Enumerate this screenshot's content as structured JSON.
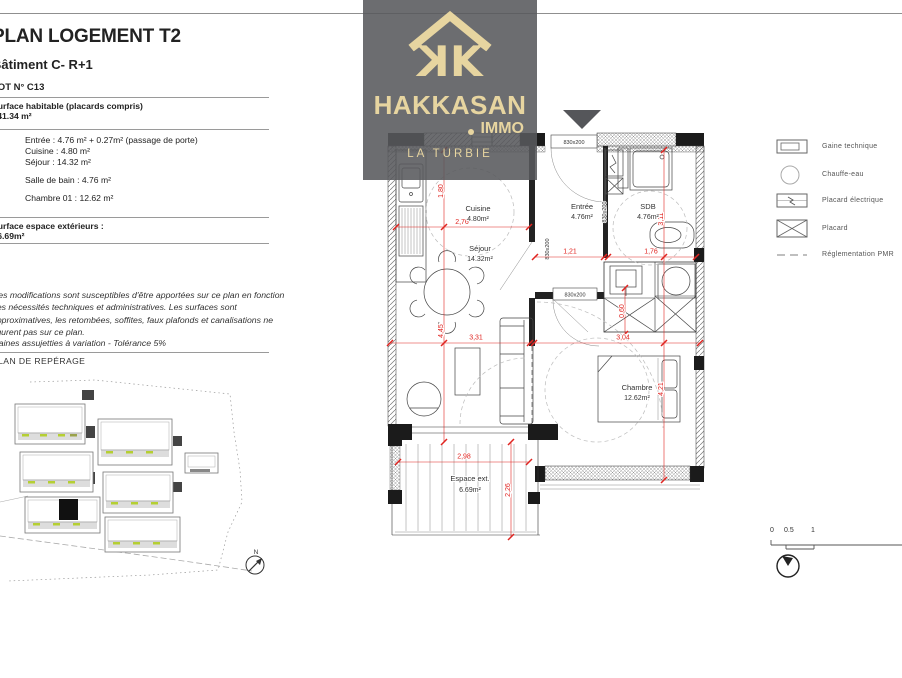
{
  "page": {
    "title": "PLAN LOGEMENT T2",
    "building": "Bâtiment C- R+1",
    "lot": "LOT N° C13"
  },
  "surfaces": {
    "habitable_label": "Surface habitable (placards compris)",
    "habitable_value": ": 41.34 m²",
    "rooms_group1": [
      "Entrée : 4.76 m² + 0.27m² (passage de porte)",
      "Cuisine : 4.80 m²",
      "Séjour : 14.32 m²"
    ],
    "rooms_group2": [
      "Salle de bain : 4.76 m²"
    ],
    "rooms_group3": [
      "Chambre 01 : 12.62 m²"
    ],
    "exterior_label": "Surface espace extérieurs :",
    "exterior_value": ": 6.69m²"
  },
  "notes": {
    "disclaimer": [
      "Des modifications sont susceptibles d'être apportées sur ce plan en fonction",
      "des nécessités techniques et administratives. Les surfaces sont",
      "approximatives, les retombées, soffites, faux plafonds et canalisations ne",
      "figurent pas sur ce plan."
    ],
    "tolerance": "Gaines assujetties à variation - Tolérance 5%"
  },
  "reperage": {
    "title": "PLAN DE REPÉRAGE",
    "north_label": "N"
  },
  "logo": {
    "brand": "HAKKASAN",
    "suffix": "IMMO",
    "location": "LA TURBIE",
    "k_letter": "K"
  },
  "plan": {
    "rooms": {
      "cuisine": {
        "name": "Cuisine",
        "area": "4.80m²"
      },
      "sejour": {
        "name": "Séjour",
        "area": "14.32m²"
      },
      "entree": {
        "name": "Entrée",
        "area": "4.76m²"
      },
      "sdb": {
        "name": "SDB",
        "area": "4.76m²"
      },
      "chambre": {
        "name": "Chambre",
        "area": "12.62m²"
      },
      "espace_ext": {
        "name": "Espace ext.",
        "area": "6.69m²"
      }
    },
    "dims": {
      "d180": "1,80",
      "d276": "2,76",
      "d121": "1,21",
      "d176": "1,76",
      "d311": "3,11",
      "d445": "4,45",
      "d331": "3,31",
      "d304": "3,04",
      "d060": "0,60",
      "d421": "4,21",
      "d298": "2,98",
      "d226": "2,26"
    },
    "door_label": "830x200"
  },
  "legend": {
    "items": [
      {
        "icon": "gaine-technique-icon",
        "label": "Gaine technique"
      },
      {
        "icon": "chauffe-eau-icon",
        "label": "Chauffe-eau"
      },
      {
        "icon": "placard-electrique-icon",
        "label": "Placard électrique"
      },
      {
        "icon": "placard-icon",
        "label": "Placard"
      },
      {
        "icon": "reglementation-pmr-icon",
        "label": "Réglementation PMR"
      }
    ]
  },
  "scale": {
    "t0": "0",
    "t05": "0.5",
    "t1": "1"
  },
  "colors": {
    "dim_red": "#e02420",
    "logo_gold": "#e7d5a0",
    "logo_gray": "#595a5c",
    "site_green": "#b5cf33"
  }
}
